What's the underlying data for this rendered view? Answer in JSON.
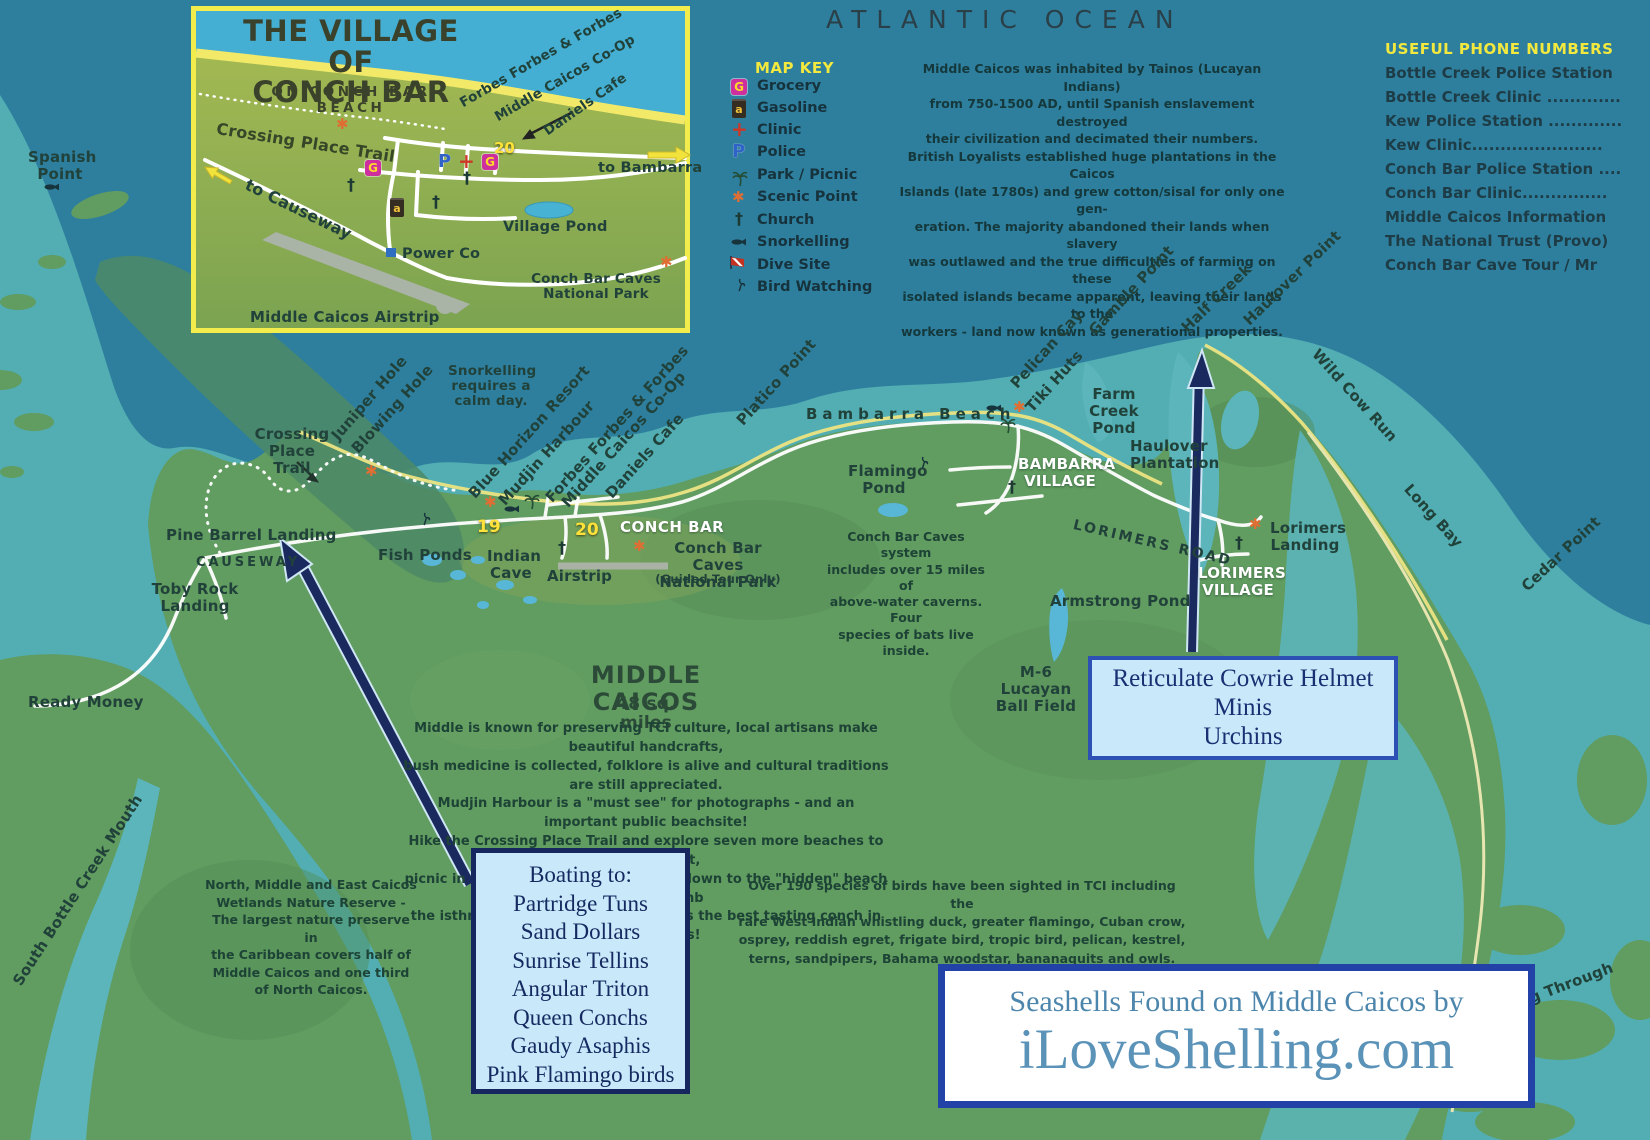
{
  "ocean_label": "ATLANTIC OCEAN",
  "glyphs": {
    "grocery": "G",
    "police": "P",
    "gasoline": "a",
    "clinic": "+",
    "scenic": "✱",
    "church": "†"
  },
  "inset": {
    "title": "THE VILLAGE OF\nCONCH BAR",
    "subtitle": "ON CONCH BAR BEACH",
    "crossing_trail": "Crossing Place Trail",
    "forbes": "Forbes Forbes & Forbes",
    "coop": "Middle Caicos Co-Op",
    "daniels": "Daniels Cafe",
    "to_bambarra": "to Bambarra",
    "to_causeway": "to Causeway",
    "village_pond": "Village Pond",
    "power_co": "Power Co",
    "caves_np": "Conch Bar Caves\nNational Park",
    "airstrip": "Middle Caicos Airstrip",
    "marker20": "20"
  },
  "map_key": {
    "title": "MAP KEY",
    "items": [
      {
        "icon": "grocery-icon",
        "label": "Grocery"
      },
      {
        "icon": "gasoline-icon",
        "label": "Gasoline"
      },
      {
        "icon": "clinic-icon",
        "label": "Clinic"
      },
      {
        "icon": "police-icon",
        "label": "Police"
      },
      {
        "icon": "park-picnic-icon",
        "label": "Park / Picnic"
      },
      {
        "icon": "scenic-point-icon",
        "label": "Scenic Point"
      },
      {
        "icon": "church-icon",
        "label": "Church"
      },
      {
        "icon": "snorkelling-icon",
        "label": "Snorkelling"
      },
      {
        "icon": "dive-site-icon",
        "label": "Dive Site"
      },
      {
        "icon": "bird-watching-icon",
        "label": "Bird Watching"
      }
    ]
  },
  "history": "Middle Caicos was inhabited by Tainos (Lucayan Indians)\nfrom 750-1500 AD, until Spanish enslavement destroyed\ntheir civilization and decimated their numbers.\nBritish Loyalists established huge plantations in the Caicos\nIslands (late 1780s) and grew cotton/sisal for only one gen-\neration. The majority abandoned their lands when slavery\nwas outlawed and the true difficulties of farming on these\nisolated islands became apparent, leaving their lands to the\nworkers - land now known as generational properties.",
  "phones": {
    "title": "USEFUL PHONE NUMBERS",
    "items": [
      "Bottle Creek Police Station",
      "Bottle Creek Clinic .............",
      "Kew Police Station .............",
      "Kew Clinic.......................",
      "Conch Bar Police Station ....",
      "Conch Bar Clinic...............",
      "Middle Caicos Information",
      "The National Trust (Provo)",
      "Conch Bar Cave Tour / Mr"
    ]
  },
  "labels": {
    "spanish_point": "Spanish\nPoint",
    "crossing_place_trail": "Crossing\nPlace Trail",
    "juniper_hole": "Juniper Hole",
    "blowing_hole": "Blowing Hole",
    "snorkel_note": "Snorkelling\nrequires a\ncalm day.",
    "blue_horizon": "Blue Horizon Resort",
    "mudjin_harbour": "Mudjin Harbour",
    "forbes": "Forbes Forbes & Forbes",
    "coop": "Middle Caicos Co-Op",
    "daniels": "Daniels Cafe",
    "pine_barrel": "Pine Barrel Landing",
    "causeway": "CAUSEWAY",
    "toby_rock": "Toby Rock\nLanding",
    "fish_ponds": "Fish Ponds",
    "indian_cave": "Indian\nCave",
    "airstrip": "Airstrip",
    "marker19": "19",
    "marker20": "20",
    "conch_bar": "CONCH BAR",
    "caves_np": "Conch Bar Caves\nNational Park",
    "guided": "(Guided Tour Only)",
    "platico": "Platico Point",
    "bambarra_beach": "Bambarra Beach",
    "pelican_cay": "Pelican Cay",
    "tiki_huts": "Tiki Huts",
    "gamble_point": "Gamble Point",
    "half_creek": "Half Creek",
    "haulover_point": "Haulover Point",
    "farm_creek_pond": "Farm\nCreek\nPond",
    "flamingo_pond": "Flamingo\nPond",
    "bambarra_village": "BAMBARRA\nVILLAGE",
    "haulover_plantation": "Haulover\nPlantation",
    "wild_cow_run": "Wild Cow Run",
    "long_bay": "Long Bay",
    "cedar_point": "Cedar Point",
    "lorimers_road": "LORIMERS ROAD",
    "lorimers_village": "LORIMERS\nVILLAGE",
    "lorimers_landing": "Lorimers\nLanding",
    "armstrong_pond": "Armstrong Pond",
    "m6": "M-6 Lucayan\nBall Field",
    "ready_money": "Ready Money",
    "south_bottle": "South Bottle Creek Mouth",
    "g_through": "g Through",
    "middle_title": "MIDDLE CAICOS",
    "sq_miles": "48 sq. miles"
  },
  "paragraphs": {
    "caves": "Conch Bar Caves system\nincludes over 15 miles of\nabove-water caverns. Four\nspecies of bats live inside.",
    "middle": "Middle is known for preserving TCI culture, local artisans make beautiful handcrafts,\nbush medicine is collected, folklore is alive and cultural traditions are still appreciated.\nMudjin Harbour is a \"must see\" for photographs - and an important public beachsite!\nHike the Crossing Place Trail and explore seven more beaches to the northwest,\npicnic in the shade of the cave, climb down to the \"hidden\" beach and beachcomb\nthe isthmus of Dragon Cay. Middle has the best tasting conch in all the Islands!",
    "wetlands": "North, Middle and East Caicos\nWetlands Nature Reserve -\nThe largest nature preserve in\nthe Caribbean covers half of\nMiddle Caicos and one third\nof North Caicos.",
    "birds": "Over 190 species of birds have been sighted in TCI including the\nrare West Indian whistling duck, greater flamingo, Cuban crow,\nosprey, reddish egret, frigate bird, tropic bird, pelican, kestrel,\nterns, sandpipers, Bahama woodstar, bananaquits and owls."
  },
  "boxes": {
    "boating": {
      "lines": [
        "Boating to:",
        "Partridge Tuns",
        "Sand Dollars",
        "Sunrise Tellins",
        "Angular Triton",
        "Queen Conchs",
        "Gaudy Asaphis",
        "Pink Flamingo birds"
      ]
    },
    "reticulate": {
      "lines": [
        "Reticulate Cowrie Helmet",
        "Minis",
        "Urchins"
      ]
    },
    "shelling": {
      "line1": "Seashells Found on Middle Caicos by",
      "line2": "iLoveShelling.com"
    }
  },
  "colors": {
    "deep_ocean": "#2e7f9e",
    "bank": "#52aeb3",
    "land": "#619c60",
    "accent_yellow": "#f3e93e",
    "navy": "#16275f",
    "box_bg": "#c9e9fb",
    "shell_blue": "#4d87ad"
  }
}
